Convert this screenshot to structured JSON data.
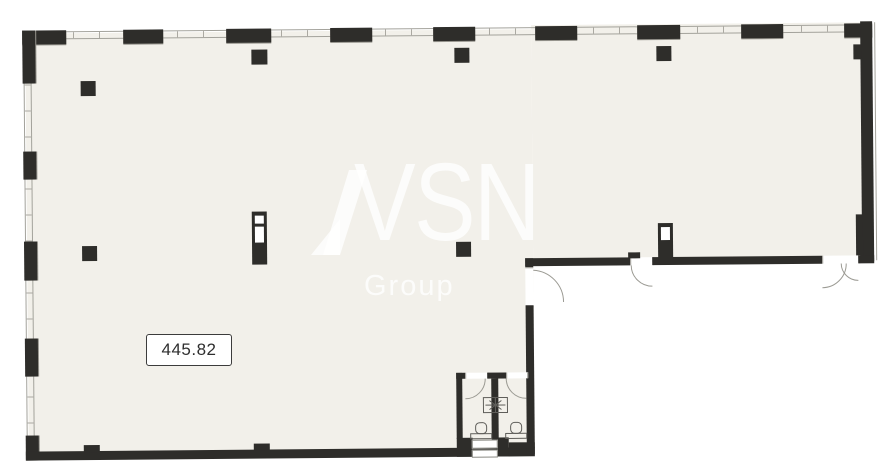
{
  "floorplan": {
    "area_label": "445.82",
    "watermark": {
      "brand": "VSN",
      "subtitle": "Group"
    }
  },
  "icons": {
    "toilet": "toilet-icon",
    "vent_shaft": "ventilation-shaft-icon",
    "door_swing": "door-swing-arc"
  },
  "colors": {
    "wall": "#2e2d2a",
    "interior": "#f2f0ea",
    "outside": "#ffffff",
    "thin_line": "#a3a29b",
    "watermark": "rgba(255,255,255,0.78)",
    "label_text": "#2e2e2e"
  }
}
